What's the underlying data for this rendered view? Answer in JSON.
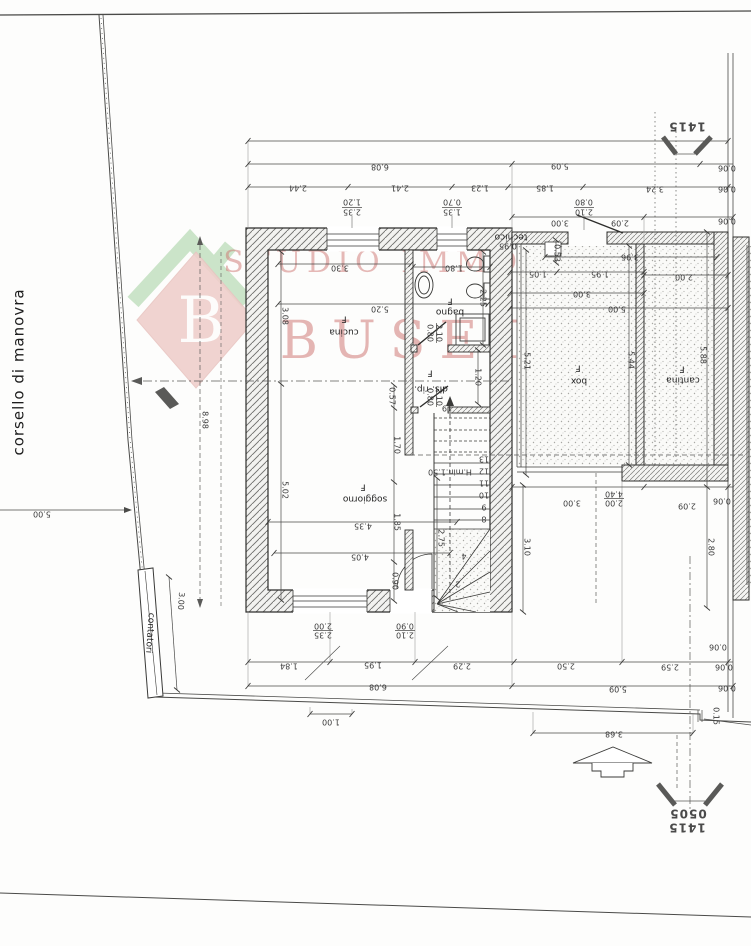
{
  "watermark": {
    "monogram": "B",
    "line1": "STUDIO IMMOBILIARE",
    "line2": "BUSETTI"
  },
  "site": {
    "road_label": "corsello di manovra"
  },
  "markers": {
    "sheet_code": "1415",
    "sheet_code_sub": "0505"
  },
  "rooms": [
    "cucina",
    "bagno",
    "dis.-rip.",
    "soggiorno",
    "box",
    "cantina",
    "tecnico",
    "contatori"
  ],
  "labels": [
    {
      "t": "corsello di manovra",
      "x": 19,
      "y": 372,
      "r": -90,
      "c": "road",
      "n": "road-label"
    },
    {
      "t": "1415",
      "x": 687,
      "y": 126,
      "c": "marker",
      "n": "sheet-marker-top"
    },
    {
      "t": "0505",
      "x": 688,
      "y": 813,
      "s": 11,
      "c": "marker",
      "n": "sheet-marker-bottom-sub"
    },
    {
      "t": "1415",
      "x": 687,
      "y": 827,
      "c": "marker",
      "n": "sheet-marker-bottom"
    },
    {
      "t": "5.00",
      "x": 42,
      "y": 514
    },
    {
      "t": "8.98",
      "x": 205,
      "y": 420,
      "r": 90
    },
    {
      "t": "contatori",
      "x": 150,
      "y": 633,
      "r": 94,
      "s": 7,
      "c": "room",
      "n": "room-label-contatori"
    },
    {
      "t": "3.00",
      "x": 181,
      "y": 601,
      "r": 94
    },
    {
      "t": "6.08",
      "x": 380,
      "y": 167
    },
    {
      "t": "5.09",
      "x": 560,
      "y": 166
    },
    {
      "t": "0.06",
      "x": 727,
      "y": 168,
      "s": 7
    },
    {
      "t": "2.44",
      "x": 298,
      "y": 188
    },
    {
      "t": "2.41",
      "x": 400,
      "y": 188
    },
    {
      "t": "1.23",
      "x": 480,
      "y": 188
    },
    {
      "t": "1.85",
      "x": 545,
      "y": 188
    },
    {
      "t": "3.24",
      "x": 655,
      "y": 189
    },
    {
      "t": "0.06",
      "x": 727,
      "y": 189,
      "s": 7
    },
    {
      "t": "1.20",
      "x": 352,
      "y": 202,
      "s": 7
    },
    {
      "t": "2.35",
      "x": 352,
      "y": 212,
      "s": 7
    },
    {
      "t": "0.70",
      "x": 452,
      "y": 202,
      "s": 7
    },
    {
      "t": "1.35",
      "x": 452,
      "y": 212,
      "s": 7
    },
    {
      "t": "0.80",
      "x": 584,
      "y": 202,
      "s": 7
    },
    {
      "t": "2.10",
      "x": 584,
      "y": 212,
      "s": 7
    },
    {
      "t": "3.00",
      "x": 560,
      "y": 223
    },
    {
      "t": "2.09",
      "x": 620,
      "y": 223
    },
    {
      "t": "0.06",
      "x": 727,
      "y": 221,
      "s": 7
    },
    {
      "t": "3.30",
      "x": 340,
      "y": 268
    },
    {
      "t": "1.80",
      "x": 454,
      "y": 268
    },
    {
      "t": "5.20",
      "x": 380,
      "y": 309
    },
    {
      "t": "2.25",
      "x": 483,
      "y": 298,
      "r": 90,
      "s": 7
    },
    {
      "t": "3.08",
      "x": 285,
      "y": 316,
      "r": 90
    },
    {
      "t": "5.02",
      "x": 285,
      "y": 490,
      "r": 90
    },
    {
      "t": "cucina",
      "x": 344,
      "y": 332,
      "c": "room",
      "n": "room-label-cucina"
    },
    {
      "t": "F",
      "x": 344,
      "y": 319,
      "c": "room"
    },
    {
      "t": "bagno",
      "x": 450,
      "y": 312,
      "c": "room",
      "n": "room-label-bagno"
    },
    {
      "t": "F",
      "x": 450,
      "y": 301,
      "c": "room"
    },
    {
      "t": "dis.-rip.",
      "x": 431,
      "y": 389,
      "s": 8,
      "c": "room",
      "n": "room-label-disimpegno"
    },
    {
      "t": "F",
      "x": 430,
      "y": 373,
      "c": "room"
    },
    {
      "t": "soggiorno",
      "x": 365,
      "y": 499,
      "c": "room",
      "n": "room-label-soggiorno"
    },
    {
      "t": "F",
      "x": 363,
      "y": 487,
      "c": "room"
    },
    {
      "t": "0.80",
      "x": 430,
      "y": 333,
      "r": 90,
      "s": 6.5
    },
    {
      "t": "2.10",
      "x": 439,
      "y": 333,
      "r": 90,
      "s": 6.5
    },
    {
      "t": "0.80",
      "x": 430,
      "y": 397,
      "r": 90,
      "s": 6.5
    },
    {
      "t": "2.10",
      "x": 439,
      "y": 397,
      "r": 90,
      "s": 6.5
    },
    {
      "t": "1.20",
      "x": 478,
      "y": 377,
      "r": 90,
      "s": 7
    },
    {
      "t": "0.57",
      "x": 392,
      "y": 396,
      "r": 90,
      "s": 7
    },
    {
      "t": "1.70",
      "x": 397,
      "y": 445,
      "r": 90
    },
    {
      "t": "1.85",
      "x": 397,
      "y": 522,
      "r": 90
    },
    {
      "t": "0.90",
      "x": 395,
      "y": 581,
      "r": 90,
      "s": 7
    },
    {
      "t": "2.75",
      "x": 441,
      "y": 538,
      "r": 90
    },
    {
      "t": "H.min.1.50",
      "x": 450,
      "y": 472,
      "s": 7
    },
    {
      "t": "4.35",
      "x": 363,
      "y": 526
    },
    {
      "t": "4.05",
      "x": 360,
      "y": 557
    },
    {
      "t": "19",
      "x": 447,
      "y": 408,
      "s": 6
    },
    {
      "t": "13",
      "x": 484,
      "y": 459,
      "s": 6
    },
    {
      "t": "12",
      "x": 484,
      "y": 471,
      "s": 6
    },
    {
      "t": "11",
      "x": 484,
      "y": 483,
      "s": 6
    },
    {
      "t": "10",
      "x": 484,
      "y": 495,
      "s": 6
    },
    {
      "t": "9",
      "x": 484,
      "y": 507,
      "s": 6
    },
    {
      "t": "8",
      "x": 484,
      "y": 519,
      "s": 6
    },
    {
      "t": "4",
      "x": 464,
      "y": 556,
      "s": 6
    },
    {
      "t": "2",
      "x": 458,
      "y": 584,
      "s": 6
    },
    {
      "t": "tecnico",
      "x": 511,
      "y": 237,
      "s": 7,
      "c": "room",
      "n": "room-label-tecnico"
    },
    {
      "t": "0.95",
      "x": 508,
      "y": 246,
      "s": 7
    },
    {
      "t": "0.53",
      "x": 557,
      "y": 253,
      "r": 90,
      "s": 7
    },
    {
      "t": "3.96",
      "x": 630,
      "y": 257
    },
    {
      "t": "1.05",
      "x": 538,
      "y": 274
    },
    {
      "t": "1.95",
      "x": 600,
      "y": 274
    },
    {
      "t": "2.00",
      "x": 684,
      "y": 277
    },
    {
      "t": "3.00",
      "x": 582,
      "y": 294
    },
    {
      "t": "5.00",
      "x": 617,
      "y": 309
    },
    {
      "t": "5.21",
      "x": 527,
      "y": 361,
      "r": 90
    },
    {
      "t": "5.44",
      "x": 631,
      "y": 360,
      "r": 90
    },
    {
      "t": "5.88",
      "x": 703,
      "y": 355,
      "r": 90
    },
    {
      "t": "box",
      "x": 579,
      "y": 381,
      "c": "room",
      "n": "room-label-box"
    },
    {
      "t": "F",
      "x": 578,
      "y": 368,
      "c": "room"
    },
    {
      "t": "cantina",
      "x": 683,
      "y": 380,
      "c": "room",
      "n": "room-label-cantina"
    },
    {
      "t": "F",
      "x": 682,
      "y": 369,
      "c": "room"
    },
    {
      "t": "3.00",
      "x": 572,
      "y": 503
    },
    {
      "t": "4.40",
      "x": 614,
      "y": 494,
      "s": 7
    },
    {
      "t": "2.00",
      "x": 614,
      "y": 503,
      "s": 7
    },
    {
      "t": "2.09",
      "x": 687,
      "y": 506
    },
    {
      "t": "0.06",
      "x": 722,
      "y": 501,
      "s": 7
    },
    {
      "t": "3.10",
      "x": 527,
      "y": 547,
      "r": 90
    },
    {
      "t": "2.80",
      "x": 711,
      "y": 547,
      "r": 90
    },
    {
      "t": "2.00",
      "x": 323,
      "y": 626,
      "s": 7
    },
    {
      "t": "2.35",
      "x": 323,
      "y": 635,
      "s": 7
    },
    {
      "t": "0.90",
      "x": 405,
      "y": 626,
      "s": 7
    },
    {
      "t": "2.10",
      "x": 405,
      "y": 635,
      "s": 7
    },
    {
      "t": "0.06",
      "x": 718,
      "y": 647,
      "s": 7
    },
    {
      "t": "1.84",
      "x": 289,
      "y": 666
    },
    {
      "t": "1.95",
      "x": 373,
      "y": 665
    },
    {
      "t": "2.29",
      "x": 462,
      "y": 666
    },
    {
      "t": "2.50",
      "x": 566,
      "y": 666
    },
    {
      "t": "2.59",
      "x": 670,
      "y": 667
    },
    {
      "t": "0.06",
      "x": 724,
      "y": 667,
      "s": 7
    },
    {
      "t": "6.08",
      "x": 378,
      "y": 687
    },
    {
      "t": "5.09",
      "x": 618,
      "y": 689
    },
    {
      "t": "0.06",
      "x": 727,
      "y": 688,
      "s": 7
    },
    {
      "t": "1.00",
      "x": 331,
      "y": 722
    },
    {
      "t": "3.68",
      "x": 614,
      "y": 734
    },
    {
      "t": "0.15",
      "x": 716,
      "y": 716,
      "r": 90,
      "s": 6.5
    }
  ]
}
